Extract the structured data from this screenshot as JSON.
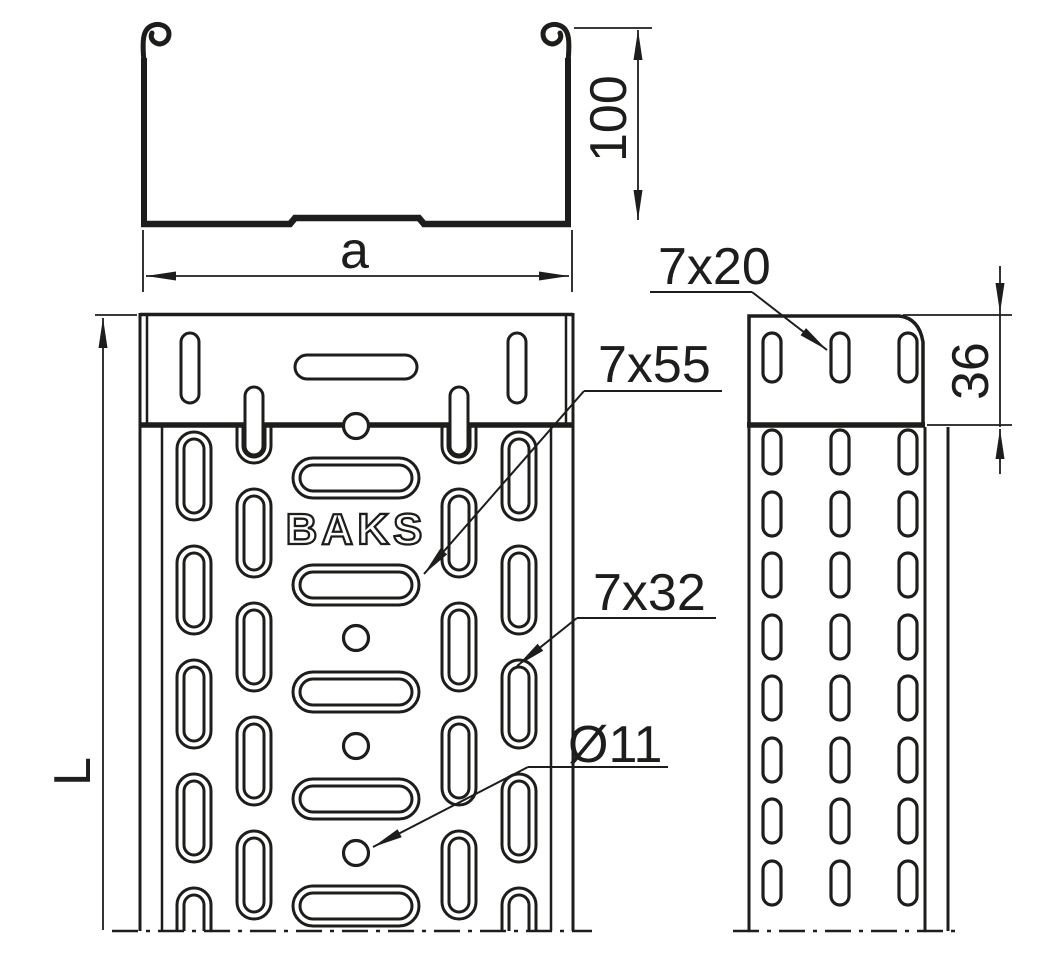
{
  "drawing": {
    "type": "technical-drawing",
    "brand": "BAKS",
    "labels": {
      "profile_height": "100",
      "profile_width": "a",
      "tray_length": "L",
      "plate_slot": "7x20",
      "plate_overlap": "36",
      "center_slot": "7x55",
      "side_slot": "7x32",
      "hole_diameter": "Ø11"
    },
    "line_color": "#1d1d1b",
    "background_color": "#ffffff"
  }
}
